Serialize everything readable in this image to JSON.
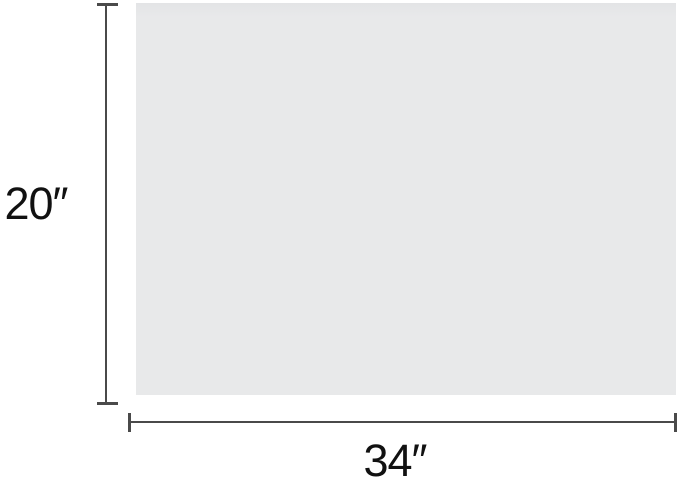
{
  "diagram": {
    "type": "product-dimension-diagram",
    "height_label": "20″",
    "width_label": "34″"
  },
  "colors": {
    "panel_fill": "#e8e9ea",
    "panel_fill_top": "#e3e4e6",
    "dimension_line": "#4a4a4a",
    "label_text": "#111111",
    "background": "#ffffff"
  }
}
